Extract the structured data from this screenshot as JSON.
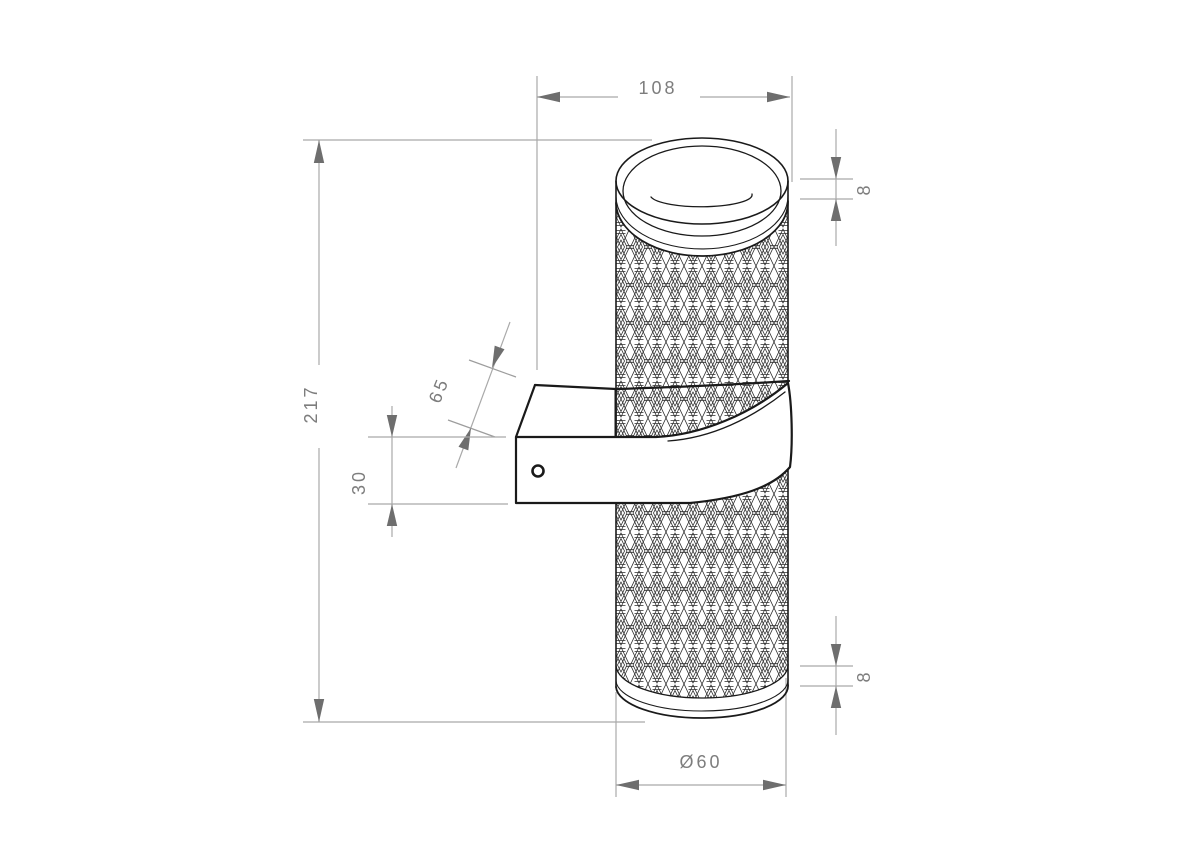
{
  "drawing": {
    "type": "technical-dimension-drawing",
    "subject": "cylindrical wall lamp with knurled body and wall bracket",
    "colors": {
      "background": "#ffffff",
      "object_line": "#1a1a1a",
      "dimension_line": "#a9a9a9",
      "dimension_arrow": "#6e6e6e",
      "dimension_text": "#7d7d7d"
    },
    "dimensions": {
      "overall_depth": {
        "label": "108",
        "orientation": "horizontal-top"
      },
      "overall_height": {
        "label": "217",
        "orientation": "vertical-left"
      },
      "bracket_reach": {
        "label": "65",
        "orientation": "diagonal"
      },
      "bracket_thickness": {
        "label": "30",
        "orientation": "vertical"
      },
      "top_rim_height": {
        "label": "8",
        "orientation": "vertical-right-top"
      },
      "bottom_rim_height": {
        "label": "8",
        "orientation": "vertical-right-bottom"
      },
      "body_diameter": {
        "label": "Ø60",
        "orientation": "horizontal-bottom"
      }
    }
  }
}
